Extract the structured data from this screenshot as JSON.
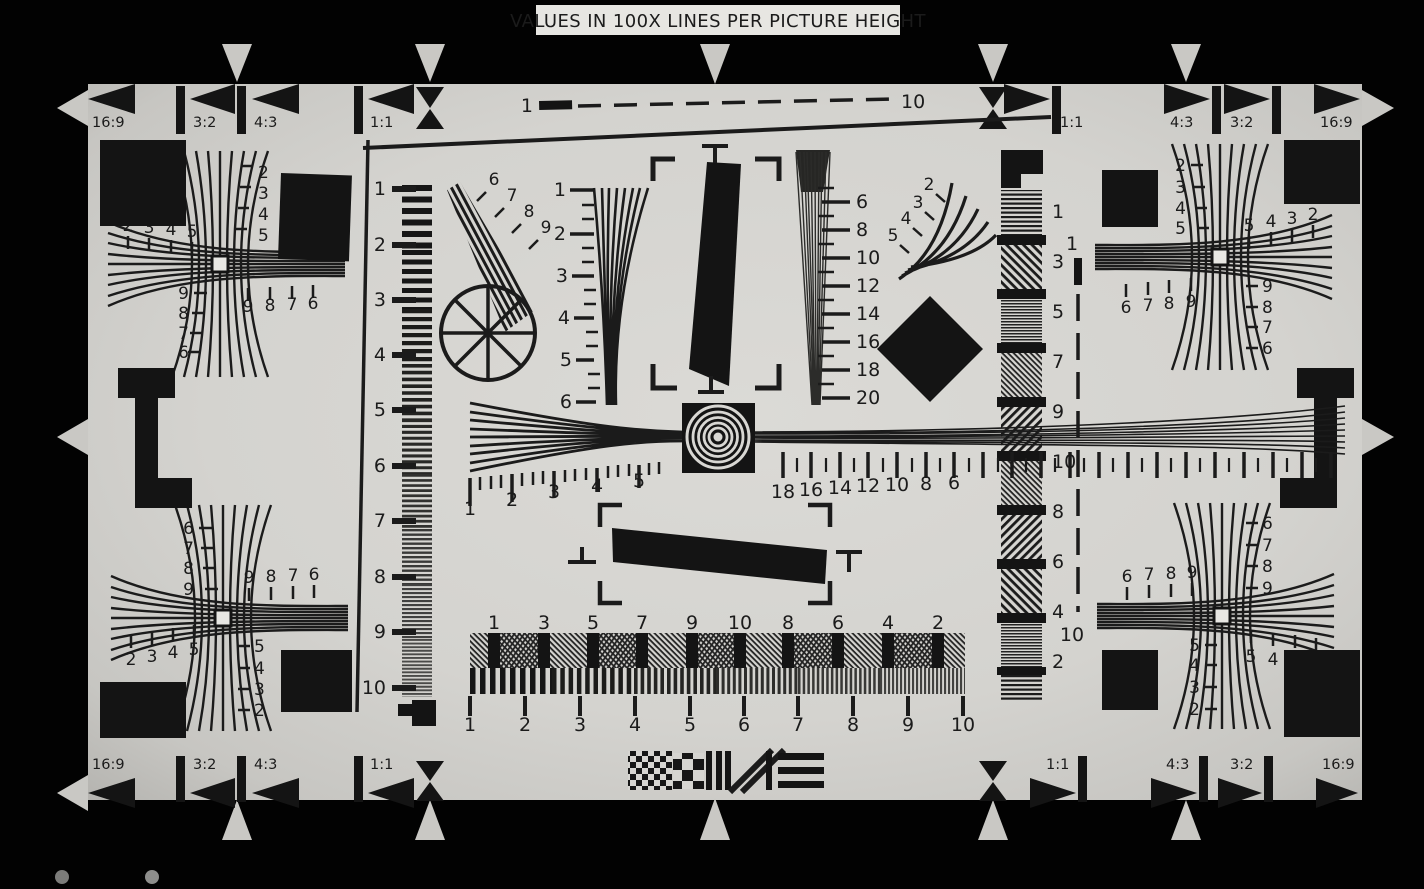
{
  "header": {
    "title": "VALUES IN 100X LINES PER PICTURE HEIGHT"
  },
  "aspect_markers": {
    "top_left": [
      "16:9",
      "3:2",
      "4:3",
      "1:1"
    ],
    "top_right": [
      "1:1",
      "4:3",
      "3:2",
      "16:9"
    ],
    "bottom_left": [
      "16:9",
      "3:2",
      "4:3",
      "1:1"
    ],
    "bottom_right": [
      "1:1",
      "4:3",
      "3:2",
      "16:9"
    ]
  },
  "scales": {
    "top_dashed": {
      "start": "1",
      "end": "10"
    },
    "right_dashed": {
      "start": "1",
      "end": "10"
    },
    "left_column": [
      "1",
      "2",
      "3",
      "4",
      "5",
      "6",
      "7",
      "8",
      "9",
      "10"
    ],
    "right_column": [
      "1",
      "3",
      "5",
      "7",
      "9",
      "10",
      "8",
      "6",
      "4",
      "2"
    ],
    "center_vertical": [
      "1",
      "2",
      "3",
      "4",
      "5",
      "6"
    ],
    "center_fine": [
      "6",
      "8",
      "10",
      "12",
      "14",
      "16",
      "18",
      "20"
    ],
    "wedge_upper_left": [
      "6",
      "7",
      "8",
      "9"
    ],
    "wedge_upper_right": [
      "2",
      "3",
      "4",
      "5"
    ],
    "ruler_left": [
      "1",
      "2",
      "3",
      "4",
      "5"
    ],
    "ruler_right": [
      "18",
      "16",
      "14",
      "12",
      "10",
      "8",
      "6"
    ],
    "bottom_row_top": [
      "1",
      "3",
      "5",
      "7",
      "9",
      "10",
      "8",
      "6",
      "4",
      "2"
    ],
    "bottom_row_bottom": [
      "1",
      "2",
      "3",
      "4",
      "5",
      "6",
      "7",
      "8",
      "9",
      "10"
    ]
  },
  "clusters": {
    "top_left": {
      "vertical": [
        "2",
        "3",
        "4",
        "5"
      ],
      "horizontal": [
        "2",
        "3",
        "4",
        "5"
      ],
      "inner_vertical": [
        "9",
        "8",
        "7",
        "6"
      ],
      "inner_horizontal": [
        "9",
        "8",
        "7",
        "6"
      ]
    },
    "top_right": {
      "vertical": [
        "2",
        "3",
        "4",
        "5"
      ],
      "horizontal": [
        "5",
        "4",
        "3",
        "2"
      ],
      "inner_vertical": [
        "9",
        "8",
        "7",
        "6"
      ],
      "inner_horizontal": [
        "6",
        "7",
        "8",
        "9"
      ]
    },
    "bottom_left": {
      "vertical": [
        "6",
        "7",
        "8",
        "9"
      ],
      "horizontal": [
        "2",
        "3",
        "4",
        "5"
      ],
      "inner_vertical": [
        "5",
        "4",
        "3",
        "2"
      ],
      "inner_horizontal": [
        "9",
        "8",
        "7",
        "6"
      ]
    },
    "bottom_right": {
      "vertical": [
        "6",
        "7",
        "8",
        "9"
      ],
      "horizontal": [
        "5",
        "4",
        "3",
        "2"
      ],
      "inner_vertical": [
        "5",
        "4",
        "3",
        "2"
      ],
      "inner_horizontal": [
        "6",
        "7",
        "8",
        "9"
      ]
    }
  },
  "colors": {
    "background": "#000000",
    "chart_surface": "#d6d5d1",
    "ink": "#1b1b1b",
    "label_box": "#e7e6e2"
  }
}
